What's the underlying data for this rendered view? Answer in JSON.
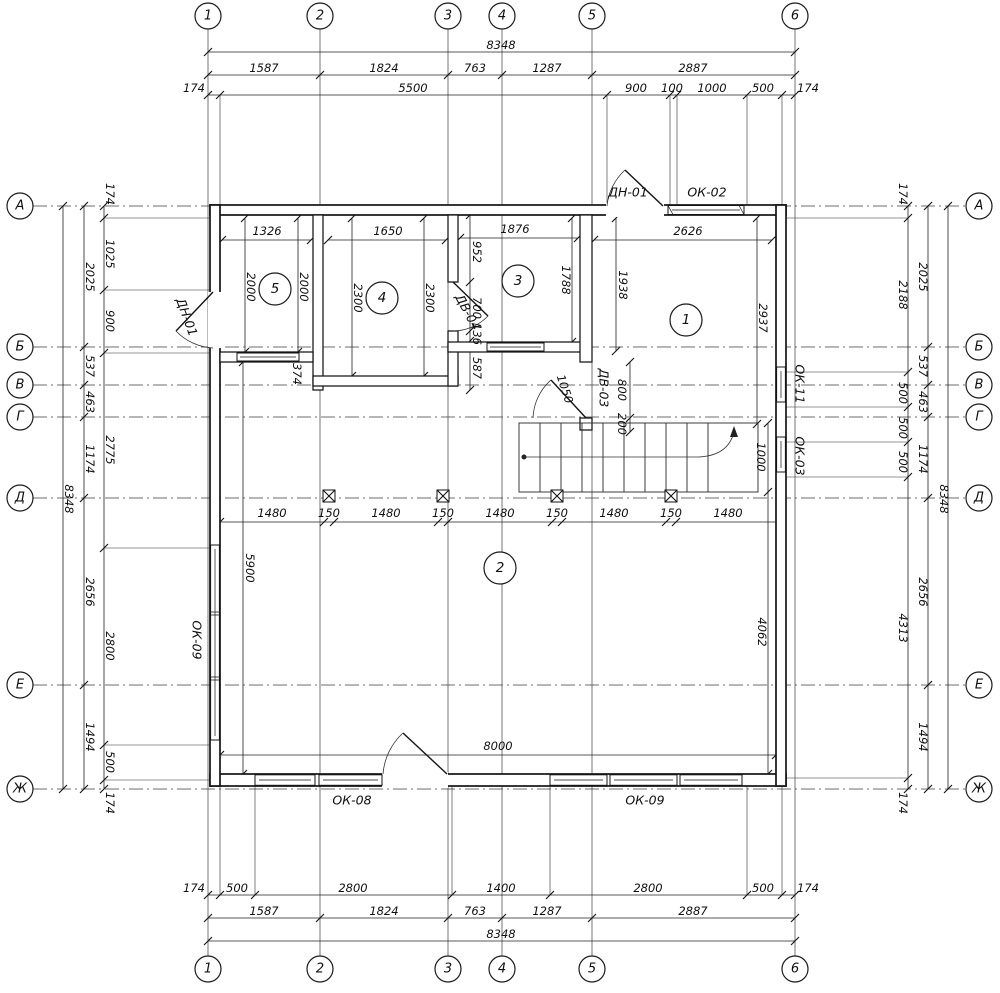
{
  "grid": {
    "cols": [
      "1",
      "2",
      "3",
      "4",
      "5",
      "6"
    ],
    "rows": [
      "А",
      "Б",
      "В",
      "Г",
      "Д",
      "Е",
      "Ж"
    ]
  },
  "dims_top": {
    "total": "8348",
    "axes": [
      "1587",
      "1824",
      "763",
      "1287",
      "2887"
    ],
    "inner": [
      "174",
      "5500",
      "900",
      "100",
      "1000",
      "500",
      "174"
    ]
  },
  "dims_bottom": {
    "inner": [
      "174",
      "500",
      "2800",
      "1400",
      "2800",
      "500",
      "174"
    ],
    "axes": [
      "1587",
      "1824",
      "763",
      "1287",
      "2887"
    ],
    "total": "8348"
  },
  "dims_left": {
    "inner": [
      "174",
      "1025",
      "900",
      "2775",
      "2800",
      "500",
      "174"
    ],
    "mid": [
      "2025",
      "537",
      "463",
      "1174",
      "2656",
      "1494"
    ],
    "total": "8348"
  },
  "dims_right": {
    "inner": [
      "174",
      "2188",
      "500",
      "500",
      "500",
      "4313",
      "174"
    ],
    "mid": [
      "2025",
      "537",
      "463",
      "1174",
      "2656",
      "1494"
    ],
    "total": "8348"
  },
  "dims_middle": [
    "1480",
    "150",
    "1480",
    "150",
    "1480",
    "150",
    "1480",
    "150",
    "1480"
  ],
  "rooms": {
    "r1": {
      "num": "1",
      "width": "2626",
      "left": "1938",
      "right": "2937"
    },
    "r2": {
      "num": "2",
      "height": "5900",
      "width": "8000",
      "right": "4062"
    },
    "r3": {
      "num": "3",
      "width": "1876",
      "right": "1788",
      "seg1": "952",
      "seg2": "700",
      "seg3": "136",
      "seg4": "587"
    },
    "r4": {
      "num": "4",
      "width": "1650",
      "left": "2300",
      "right": "2300"
    },
    "r5": {
      "num": "5",
      "width": "1326",
      "left": "2000",
      "right": "2000",
      "wall": "374"
    }
  },
  "stairs": {
    "width_dim": "1000"
  },
  "openings": {
    "door_left": "ДН-01",
    "door_top": "ДН-01",
    "win_top": "ОК-02",
    "win_right_1": "ОК-11",
    "win_right_2": "ОК-03",
    "win_left": "ОК-09",
    "win_bottom_left": "ОК-08",
    "win_bottom_right": "ОК-09",
    "door_int_1": "ДВ-04",
    "door_int_2": "ДВ-03",
    "dv03_width": "800",
    "dv03_offset": "200",
    "dv03_swing": "1050"
  }
}
